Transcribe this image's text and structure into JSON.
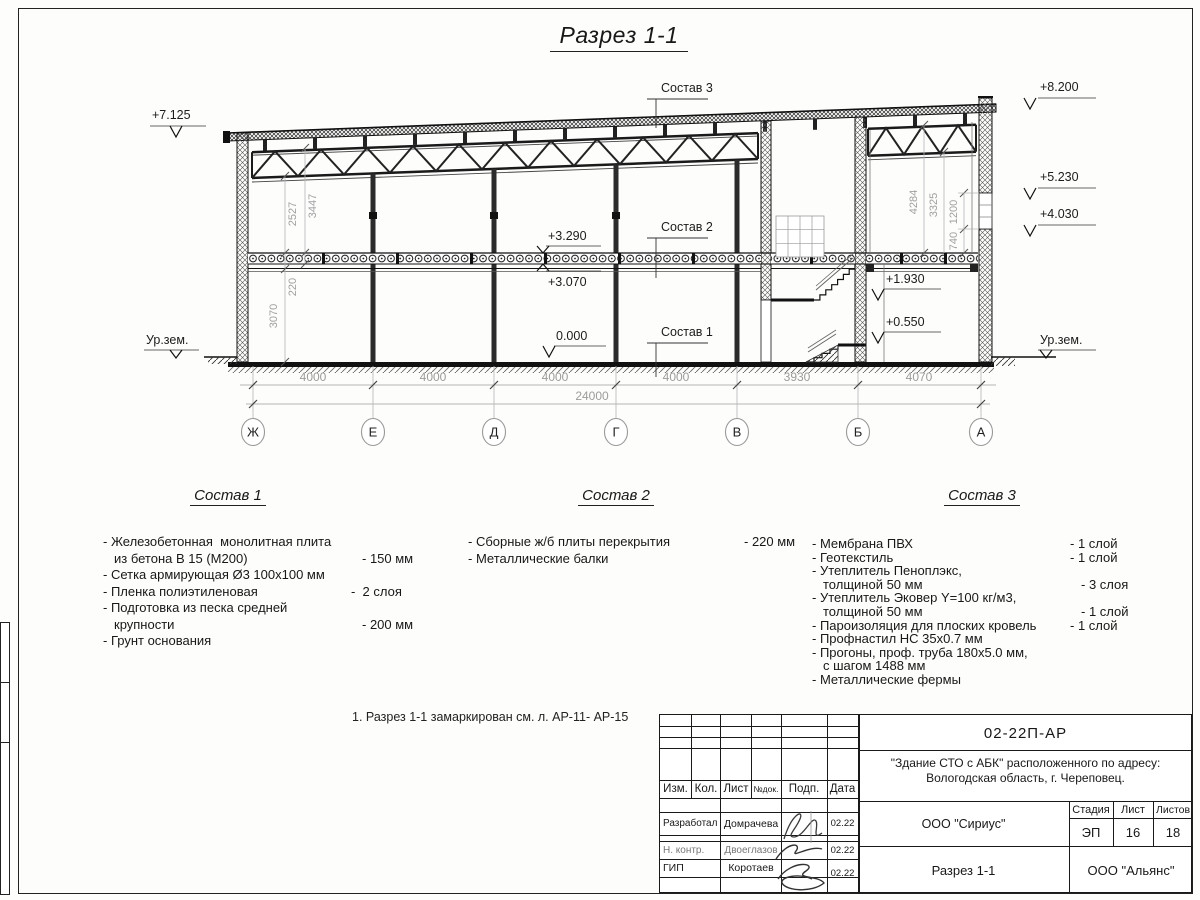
{
  "title": "Разрез 1-1",
  "drawing": {
    "elevations": {
      "e7125": "+7.125",
      "e8200": "+8.200",
      "e5230": "+5.230",
      "e4030": "+4.030",
      "e3290": "+3.290",
      "e3070": "+3.070",
      "e0000": "0.000",
      "e1930": "+1.930",
      "e0550": "+0.550",
      "ground_left": "Ур.зем.",
      "ground_right": "Ур.зем."
    },
    "layer_labels": {
      "sostav1": "Состав 1",
      "sostav2": "Состав 2",
      "sostav3": "Состав 3"
    },
    "vdims": {
      "d2527": "2527",
      "d3447": "3447",
      "d220": "220",
      "d3070": "3070",
      "d4284": "4284",
      "d3325": "3325",
      "d1200": "1200",
      "d740": "740"
    },
    "hdims": {
      "spans": [
        "4000",
        "4000",
        "4000",
        "4000",
        "3930",
        "4070"
      ],
      "total": "24000"
    },
    "axes": [
      "Ж",
      "Е",
      "Д",
      "Г",
      "В",
      "Б",
      "А"
    ]
  },
  "compositions": [
    {
      "title": "Состав 1",
      "items": [
        {
          "text": "- Железобетонная  монолитная плита",
          "value": ""
        },
        {
          "text": "из бетона В 15 (М200)",
          "value": "- 150 мм"
        },
        {
          "text": "- Сетка армирующая Ø3 100х100 мм",
          "value": ""
        },
        {
          "text": "- Пленка полиэтиленовая",
          "value": "-  2 слоя"
        },
        {
          "text": "- Подготовка из песка средней",
          "value": ""
        },
        {
          "text": "крупности",
          "value": "- 200 мм"
        },
        {
          "text": "- Грунт основания",
          "value": ""
        }
      ]
    },
    {
      "title": "Состав 2",
      "items": [
        {
          "text": "- Сборные ж/б плиты перекрытия",
          "value": "- 220 мм"
        },
        {
          "text": "- Металлические балки",
          "value": ""
        }
      ]
    },
    {
      "title": "Состав 3",
      "items": [
        {
          "text": "- Мембрана ПВХ",
          "value": "- 1 слой"
        },
        {
          "text": "- Геотекстиль",
          "value": "- 1 слой"
        },
        {
          "text": "- Утеплитель Пеноплэкс,",
          "value": ""
        },
        {
          "text": "толщиной 50 мм",
          "value": "- 3 слоя"
        },
        {
          "text": "- Утеплитель Эковер Y=100 кг/м3,",
          "value": ""
        },
        {
          "text": "толщиной 50 мм",
          "value": "- 1 слой"
        },
        {
          "text": "- Пароизоляция для плоских кровель",
          "value": "- 1 слой"
        },
        {
          "text": "- Профнастил НС 35х0.7 мм",
          "value": ""
        },
        {
          "text": "- Прогоны, проф. труба 180х5.0 мм,",
          "value": ""
        },
        {
          "text": "с шагом 1488 мм",
          "value": ""
        },
        {
          "text": "- Металлические фермы",
          "value": ""
        }
      ]
    }
  ],
  "note": "1. Разрез 1-1 замаркирован см. л. АР-11- АР-15",
  "titleblock": {
    "doc_code": "02-22П-АР",
    "project_line1": "\"Здание СТО с АБК\" расположенного по адресу:",
    "project_line2": "Вологодская область, г. Череповец.",
    "columns": [
      "Изм.",
      "Кол.",
      "Лист",
      "№док.",
      "Подп.",
      "Дата"
    ],
    "rows": [
      {
        "role": "Разработал",
        "name": "Домрачева",
        "date": "02.22"
      },
      {
        "role": "Н. контр.",
        "name": "Двоеглазов",
        "date": "02.22"
      },
      {
        "role": "ГИП",
        "name": "Коротаев",
        "date": "02.22"
      }
    ],
    "org1": "ООО \"Сириус\"",
    "org2": "ООО \"Альянс\"",
    "sheet_title": "Разрез 1-1",
    "stage_label": "Стадия",
    "sheet_label": "Лист",
    "sheets_label": "Листов",
    "stage": "ЭП",
    "sheet": "16",
    "sheets": "18"
  }
}
